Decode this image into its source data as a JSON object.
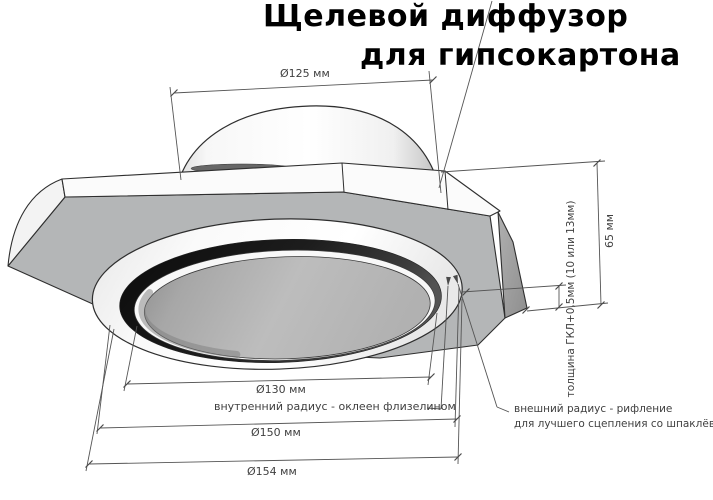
{
  "title": {
    "line1": "Щелевой диффузор",
    "line2": "для гипсокартона"
  },
  "dimensions": {
    "collar_diameter": "Ø125 мм",
    "inner_ring_diameter": "Ø130 мм",
    "ring_diameter": "Ø150 мм",
    "outer_diameter": "Ø154 мм",
    "height": "65 мм",
    "board_thickness": "толщина ГКЛ+0,5мм (10 или 13мм)"
  },
  "callouts": {
    "inner_radius": "внутренний радиус - оклеен флизелином",
    "outer_radius_line1": "внешний радиус - рифление",
    "outer_radius_line2": "для лучшего сцепления со шпаклёвкой"
  },
  "colors": {
    "background": "#ffffff",
    "outline": "#2e2e2e",
    "dimension_line": "#555555",
    "label_text": "#3f3f3f",
    "title_text": "#000000",
    "plate_underside_gray": "#b4b6b7",
    "slot_dark": "#1e1e1e",
    "disc_gray": "#b8b8b8"
  }
}
